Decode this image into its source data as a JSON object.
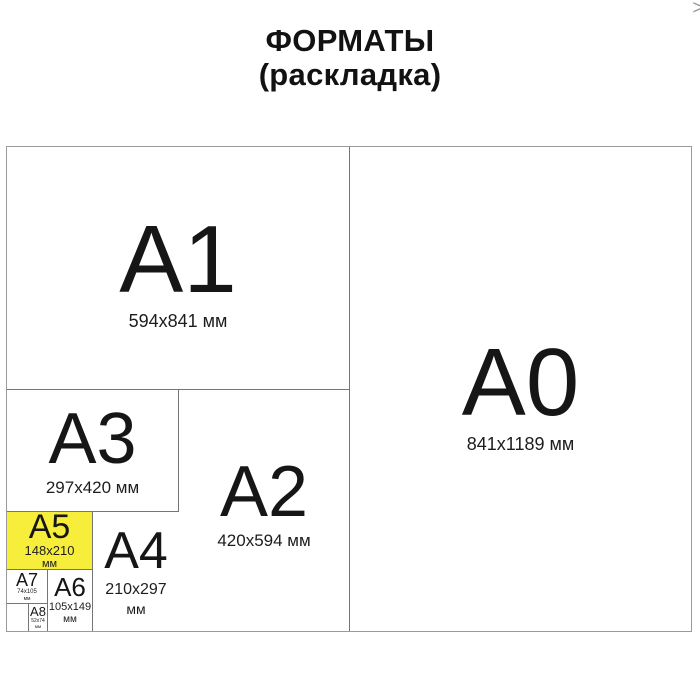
{
  "title": {
    "line1": "ФОРМАТЫ",
    "line2": "(раскладка)"
  },
  "nav": {
    "next_icon": ">"
  },
  "colors": {
    "highlight_fill": "#f7ee3c",
    "outer_border": "#9a9a9a",
    "inner_border": "#757575",
    "text": "#161616"
  },
  "formats": {
    "a0": {
      "label": "A0",
      "dims": "841x1189 мм"
    },
    "a1": {
      "label": "A1",
      "dims": "594x841 мм"
    },
    "a2": {
      "label": "A2",
      "dims": "420x594 мм"
    },
    "a3": {
      "label": "A3",
      "dims": "297x420 мм"
    },
    "a4": {
      "label": "A4",
      "dims": "210x297",
      "unit": "мм"
    },
    "a5": {
      "label": "A5",
      "dims": "148x210",
      "unit": "мм",
      "highlighted": true
    },
    "a6": {
      "label": "A6",
      "dims": "105x149",
      "unit": "мм"
    },
    "a7": {
      "label": "A7",
      "dims": "74x105",
      "unit": "мм"
    },
    "a8": {
      "label": "A8",
      "dims": "52x74",
      "unit": "мм"
    }
  }
}
